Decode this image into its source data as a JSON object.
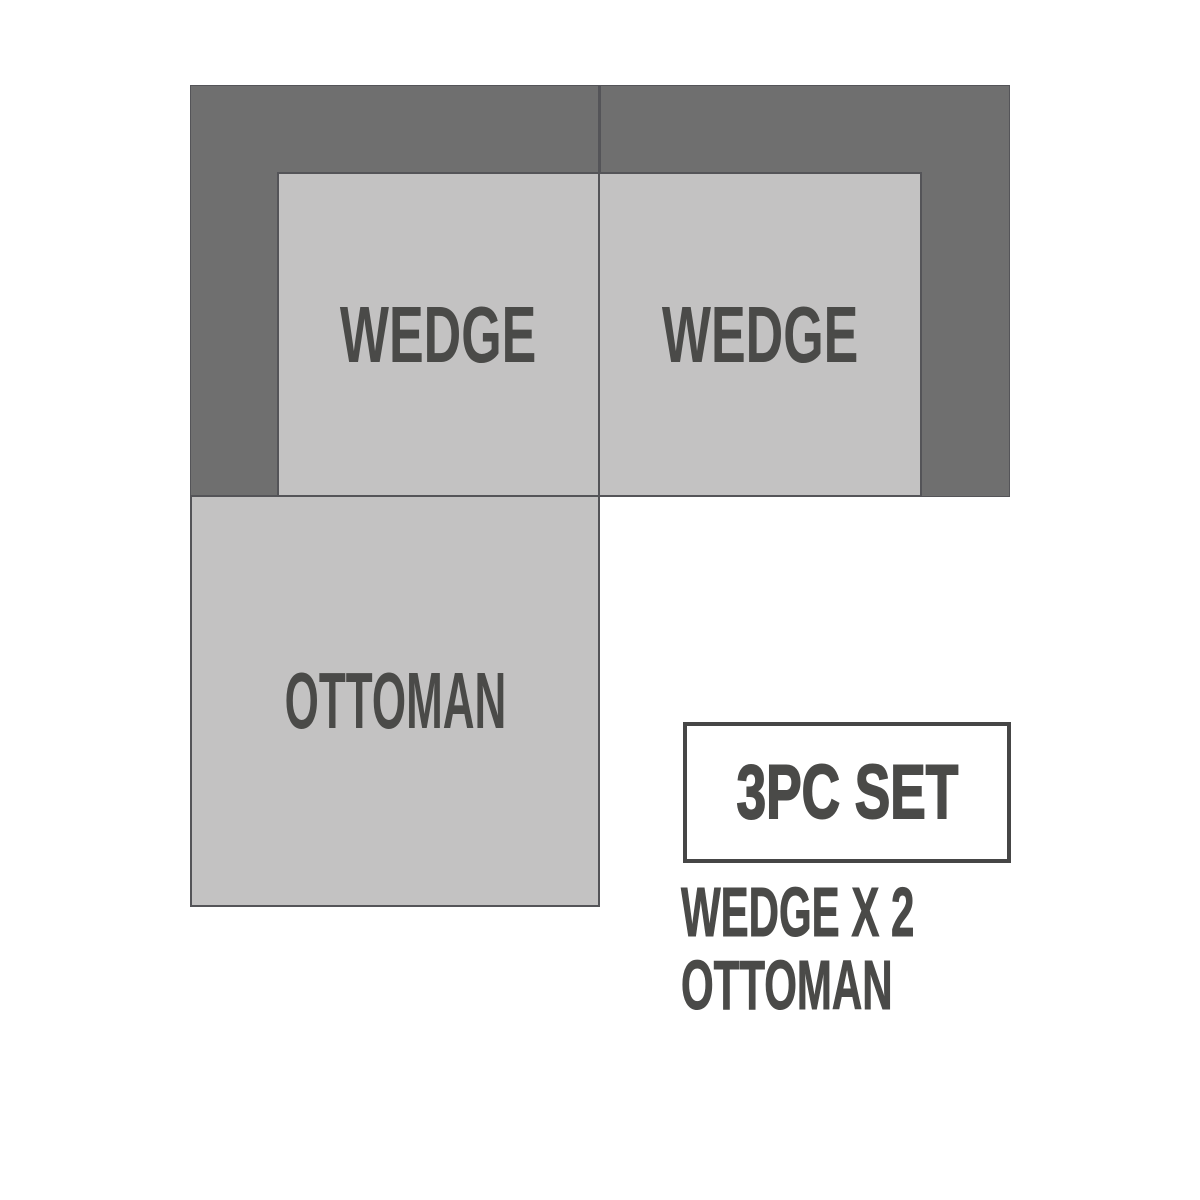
{
  "diagram": {
    "title": "sectional-sofa-3pc-set-layout",
    "pieces": [
      {
        "id": "wedge-left",
        "label": "WEDGE"
      },
      {
        "id": "wedge-right",
        "label": "WEDGE"
      },
      {
        "id": "ottoman",
        "label": "OTTOMAN"
      }
    ],
    "set_badge": {
      "label": "3PC SET"
    },
    "legend": {
      "lines": [
        "WEDGE X 2",
        "OTTOMAN"
      ]
    }
  },
  "colors": {
    "background": "#ffffff",
    "back_dark": "#6f6f6f",
    "seat_light": "#c3c2c2",
    "seam": "#545458",
    "box_border": "#464646",
    "label_text": "#4a4a48"
  }
}
